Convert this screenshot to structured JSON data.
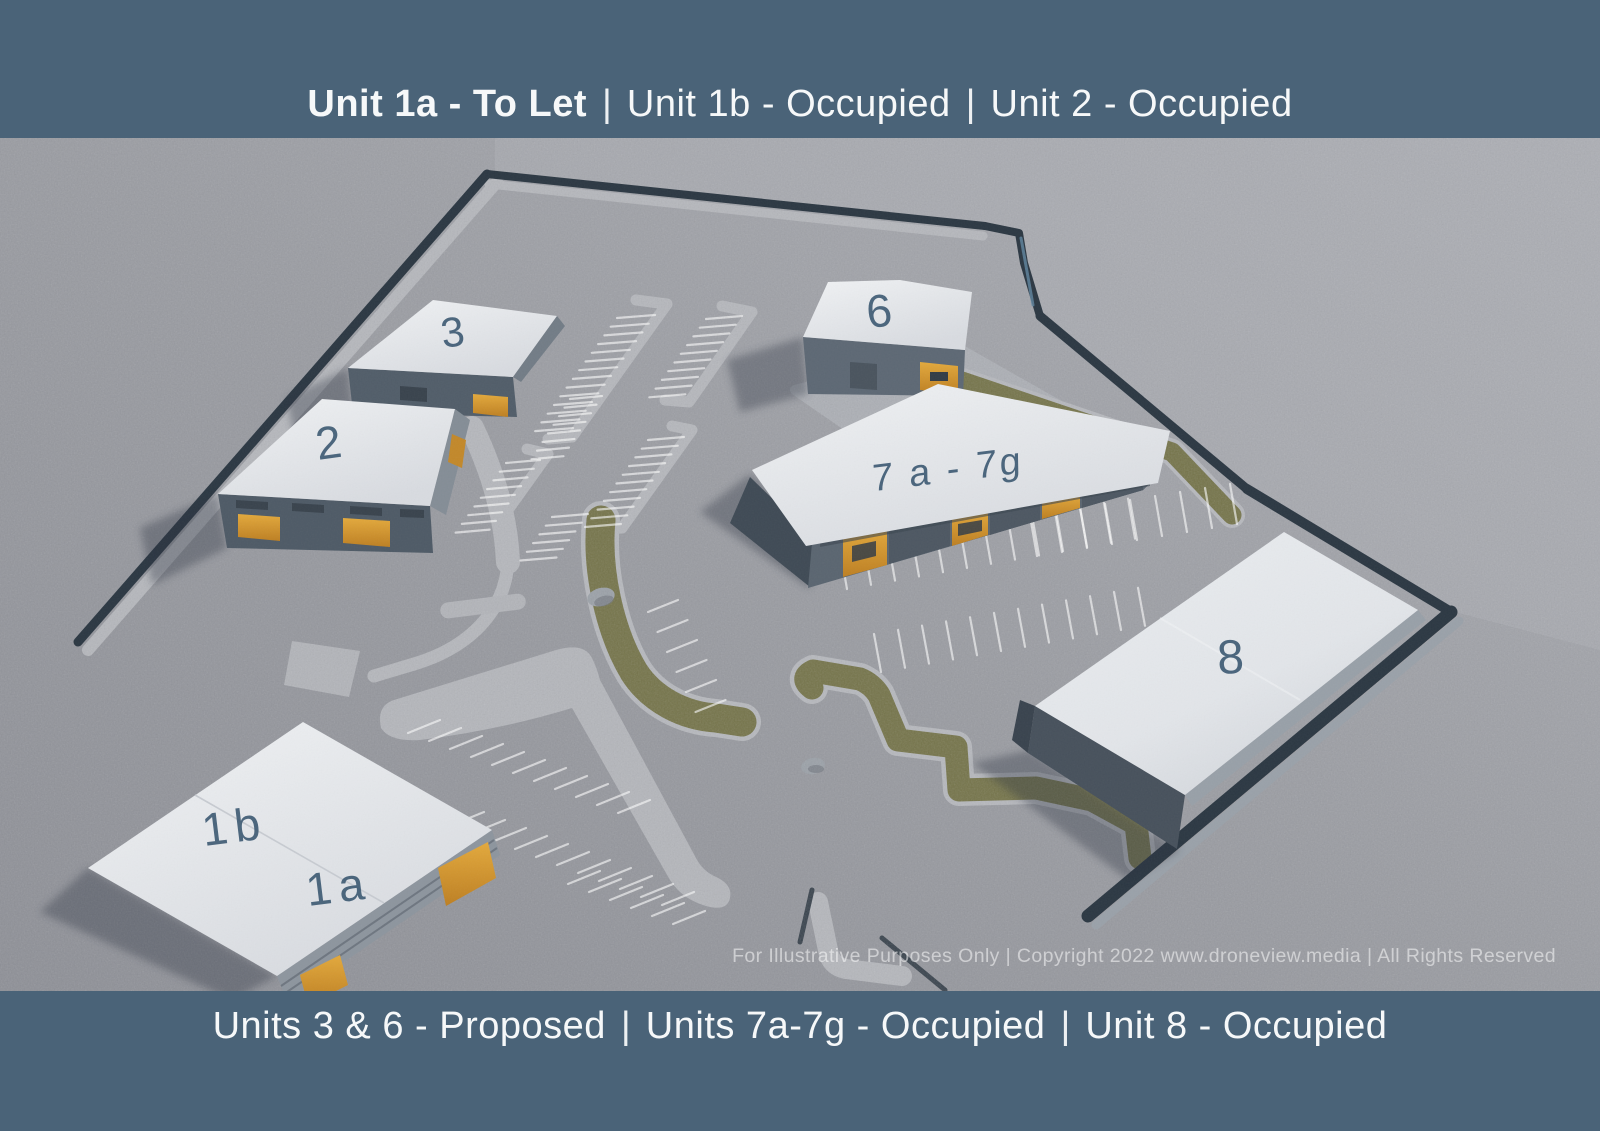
{
  "header": {
    "separator": "|",
    "segments": [
      {
        "text": "Unit 1a - To Let",
        "style": "bold"
      },
      {
        "text": "Unit 1b - Occupied",
        "style": "regular"
      },
      {
        "text": "Unit 2 - Occupied",
        "style": "regular"
      }
    ]
  },
  "footer": {
    "separator": "|",
    "segments": [
      {
        "text": "Units 3 & 6 - Proposed"
      },
      {
        "text": "Units 7a-7g - Occupied"
      },
      {
        "text": "Unit 8 - Occupied"
      }
    ]
  },
  "watermark": "For Illustrative Purposes Only | Copyright 2022 www.droneview.media | All Rights Reserved",
  "site": {
    "unit_labels": {
      "u3": "3",
      "u2": "2",
      "u6": "6",
      "u7": "7 a - 7g",
      "u8": "8",
      "u1b": "1b",
      "u1a": "1a"
    },
    "colors": {
      "banner": "#4a6378",
      "label": "#3d5a73",
      "door_accent": "#d99a2f",
      "roof": "#e9ebee",
      "grass": "#75744a",
      "tarmac": "#97999f",
      "hedge": "#2c3843"
    }
  }
}
